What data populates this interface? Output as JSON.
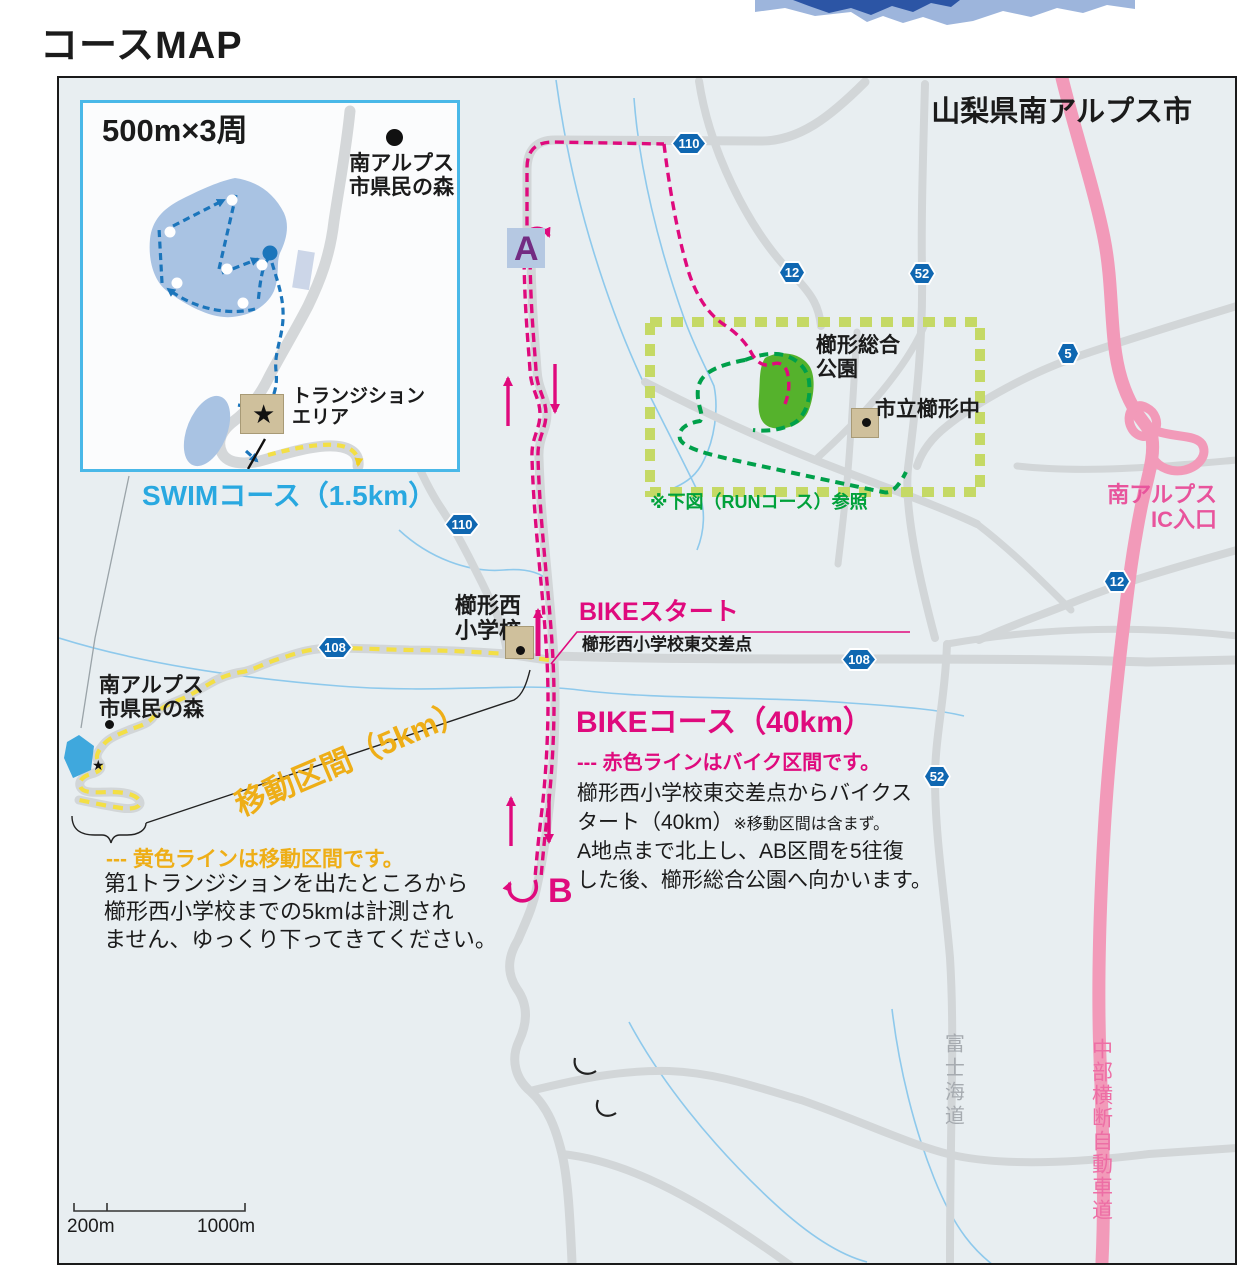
{
  "page": {
    "title": "コースMAP"
  },
  "map": {
    "region_label": "山梨県南アルプス市",
    "inset": {
      "laps": "500m×3周",
      "forest1": "南アルプス",
      "forest2": "市県民の森",
      "transition1": "トランジション",
      "transition2": "エリア",
      "star": "★"
    },
    "swim": {
      "title": "SWIMコース（1.5km）"
    },
    "bike": {
      "start": "BIKEスタート",
      "start_sub": "櫛形西小学校東交差点",
      "title": "BIKEコース（40km）",
      "legend": "--- 赤色ラインはバイク区間です。",
      "line1": "櫛形西小学校東交差点からバイクス",
      "line2": "タート（40km）",
      "line2_note": "※移動区間は含まず。",
      "line3": "A地点まで北上し、AB区間を5往復",
      "line4": "した後、櫛形総合公園へ向かいます。",
      "point_a": "A",
      "point_b": "B"
    },
    "transfer": {
      "title": "移動区間（5km）",
      "legend": "--- 黄色ラインは移動区間です。",
      "line1": "第1トランジションを出たところから",
      "line2": "櫛形西小学校までの5kmは計測され",
      "line3": "ません、ゆっくり下ってきてください。"
    },
    "run": {
      "note": "※下図（RUNコース）参照"
    },
    "places": {
      "forest1": "南アルプス",
      "forest2": "市県民の森",
      "school1": "櫛形西",
      "school2": "小学校",
      "park1": "櫛形総合",
      "park2": "公園",
      "junior_high": "市立櫛形中",
      "ic1": "南アルプス",
      "ic2": "IC入口",
      "expressway": "中部横断自動車道",
      "fuji_road": "富士海道",
      "star": "★"
    },
    "badges": {
      "r110": "110",
      "r12": "12",
      "r52": "52",
      "r5": "5",
      "r108": "108"
    },
    "scale": {
      "small": "200m",
      "large": "1000m"
    },
    "colors": {
      "bike": "#df0a7d",
      "swim": "#29a8e0",
      "transfer_line": "#f3df45",
      "transfer_label": "#eeae17",
      "run": "#00a04a",
      "run_area": "#c5d965",
      "highway": "#f29ab9",
      "badge_blue": "#0f67b1",
      "park_green": "#55b22c"
    }
  }
}
